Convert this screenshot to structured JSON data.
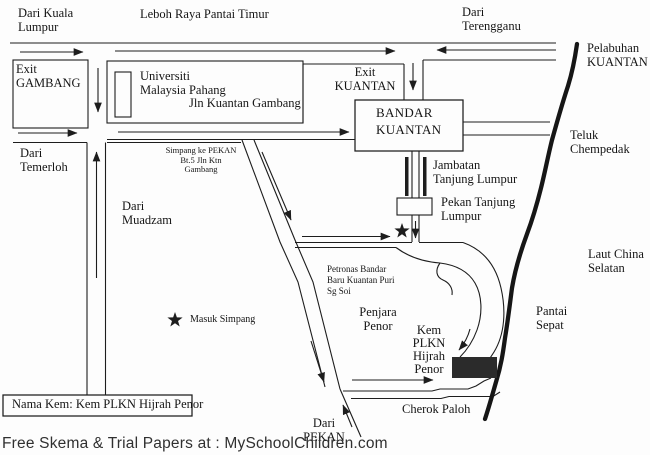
{
  "labels": {
    "dari_kuala_lumpur": "Dari Kuala\nLumpur",
    "leboh_raya_pantai_timur": "Leboh Raya Pantai Timur",
    "dari_terengganu": "Dari\nTerengganu",
    "exit_gambang": "Exit\nGAMBANG",
    "universiti_malaysia_pahang": "Universiti\nMalaysia Pahang",
    "jln_kuantan_gambang": "Jln Kuantan Gambang",
    "exit_kuantan": "Exit\nKUANTAN",
    "bandar_kuantan": "BANDAR\nKUANTAN",
    "dari_temerloh": "Dari\nTemerloh",
    "simpang_ke_pekan": "Simpang ke PEKAN\nBt.5 Jln Ktn\nGambang",
    "dari_muadzam": "Dari\nMuadzam",
    "jambatan_tanjung_lumpur": "Jambatan\nTanjung Lumpur",
    "pekan_tanjung_lumpur": "Pekan Tanjung\nLumpur",
    "pelabuhan_kuantan": "Pelabuhan\nKUANTAN",
    "teluk_chempedak": "Teluk\nChempedak",
    "laut_china_selatan": "Laut China\nSelatan",
    "pantai_sepat": "Pantai\nSepat",
    "petronas_bandar_baru": "Petronas Bandar\nBaru Kuantan Puri\nSg Soi",
    "penjara_penor": "Penjara\nPenor",
    "kem_plkn_hijrah_penor": "Kem\nPLKN\nHijrah\nPenor",
    "masuk_simpang": "Masuk Simpang",
    "cherok_paloh": "Cherok Paloh",
    "dari_pekan": "Dari\nPEKAN",
    "nama_kem": "Nama Kem: Kem PLKN Hijrah Penor"
  },
  "footer": "Free Skema & Trial Papers at : MySchoolChildren.com",
  "icons": {
    "junction_star": "★",
    "legend_star": "★"
  },
  "colors": {
    "ink": "#1d1d1d",
    "camp_fill": "#2b2b2b",
    "background": "#fdfdfd"
  }
}
